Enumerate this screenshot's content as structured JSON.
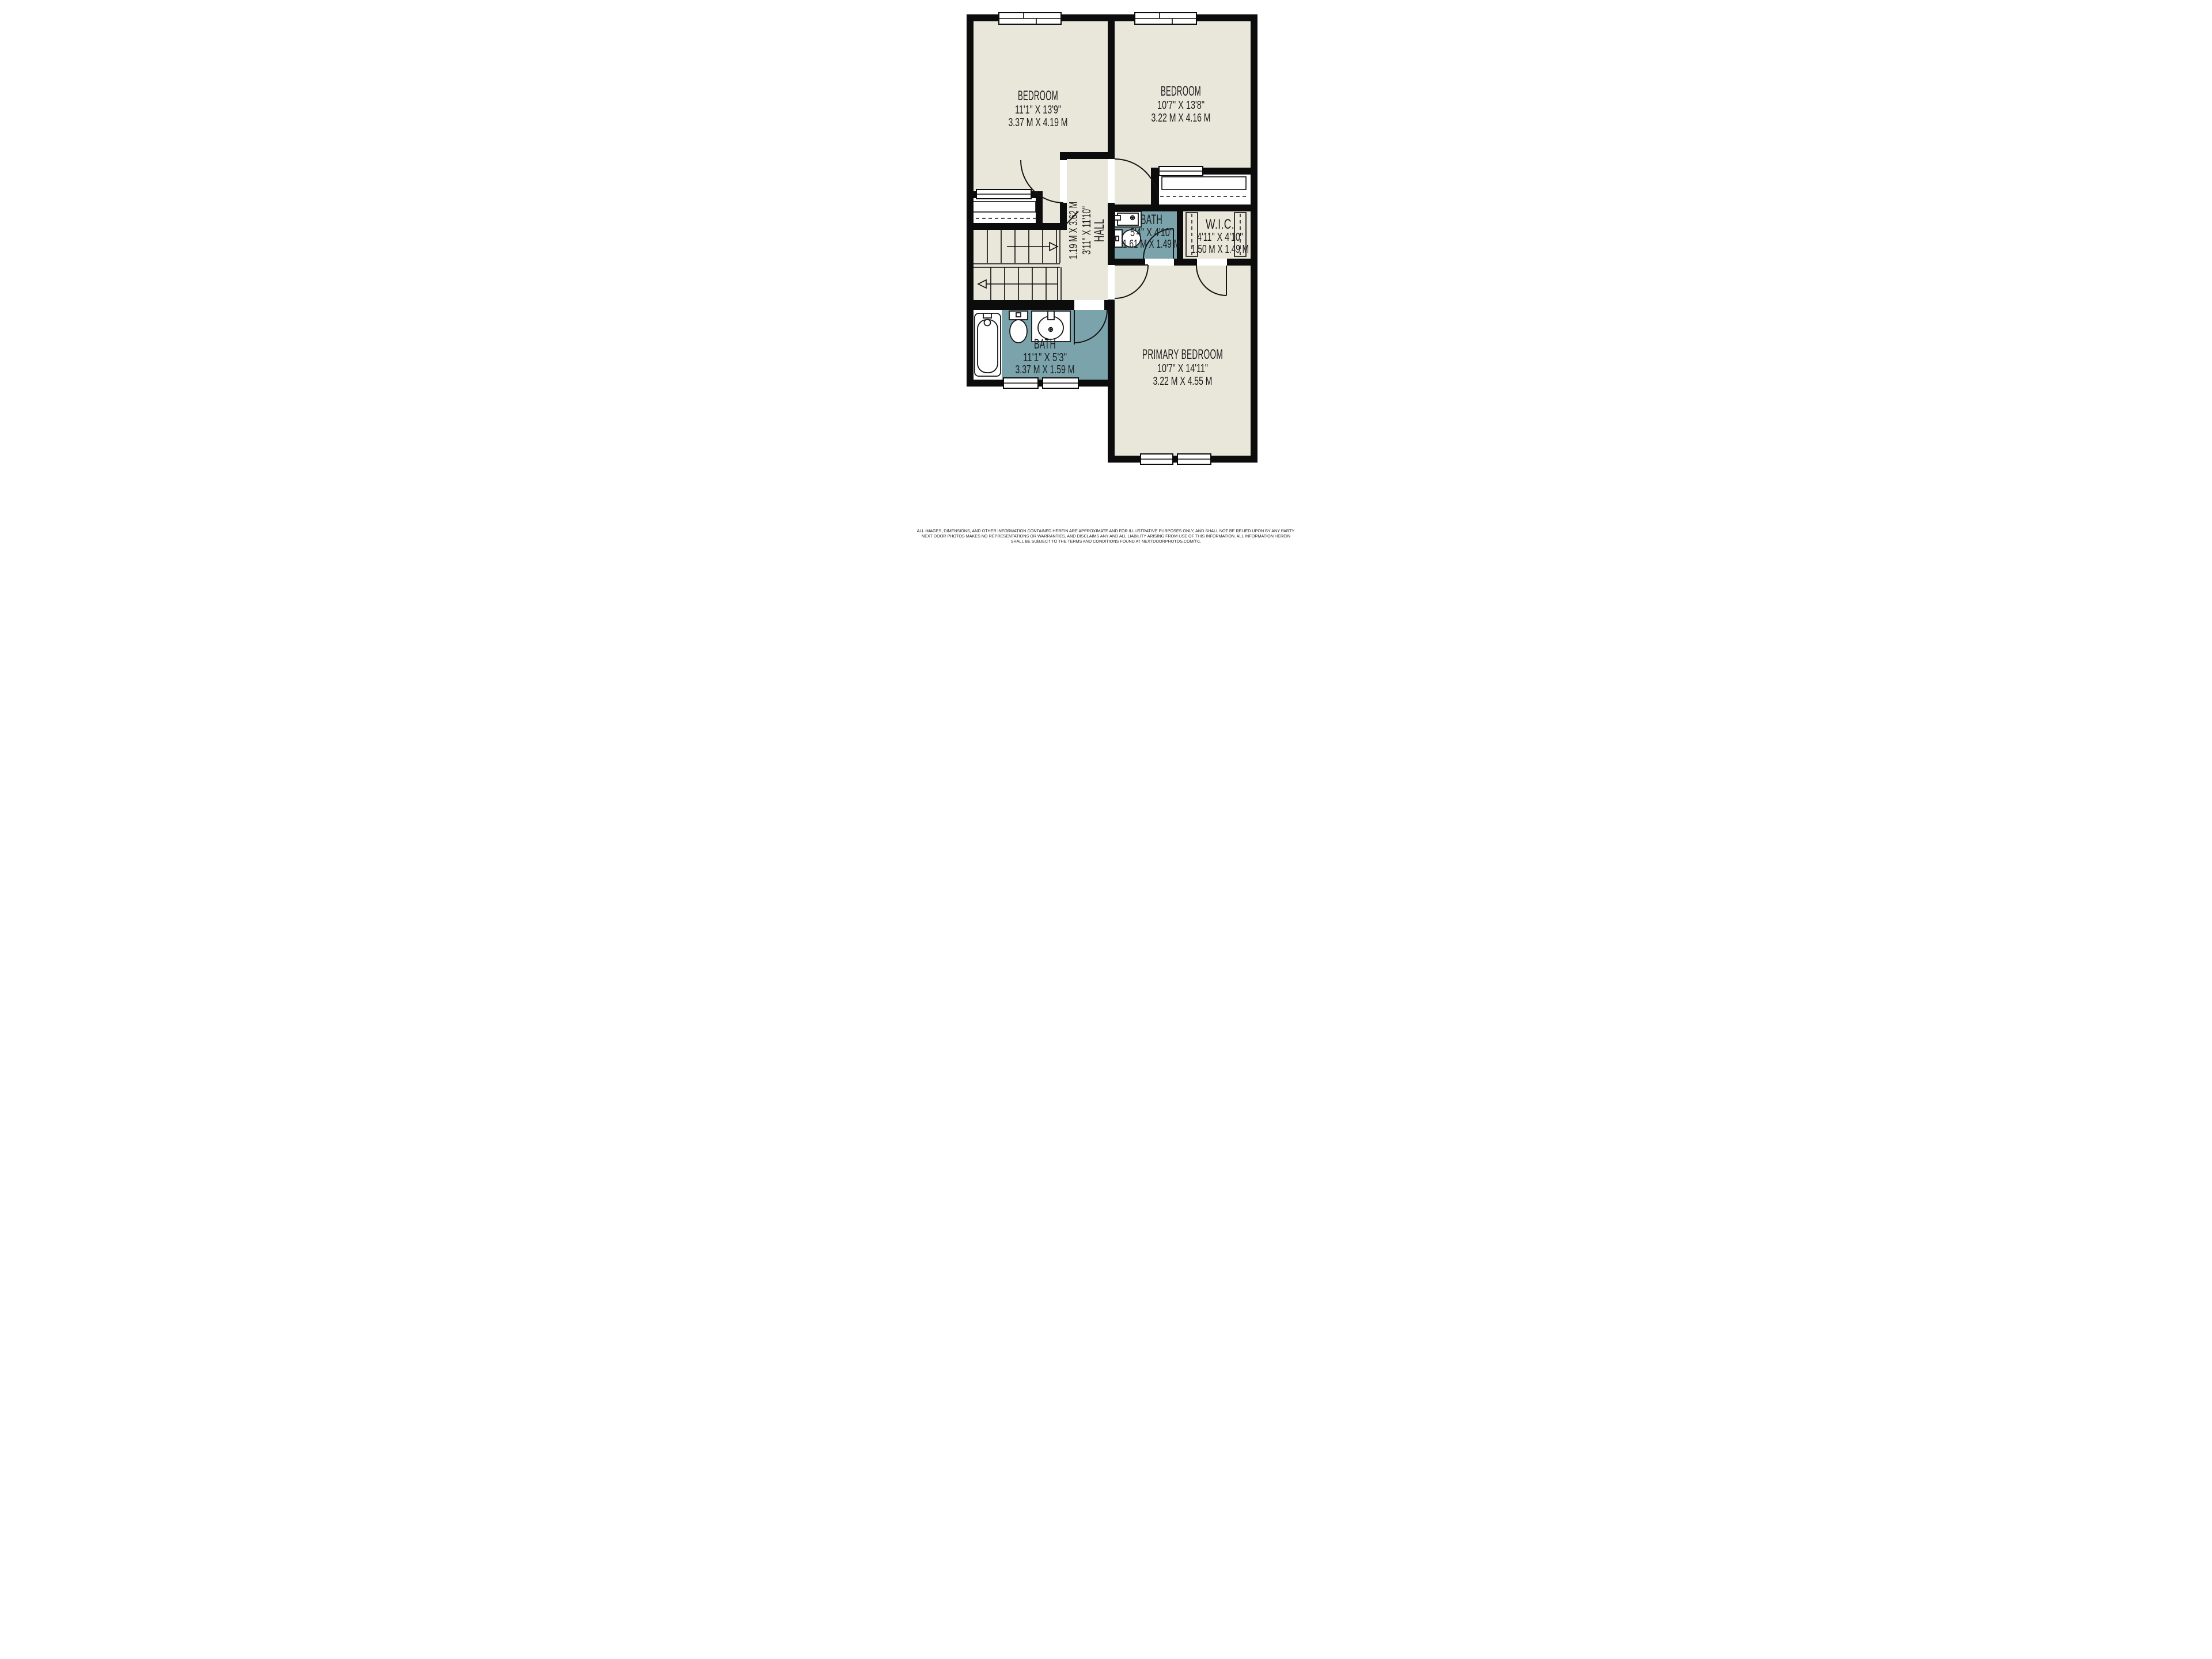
{
  "rooms": {
    "bedroom1": {
      "name": "BEDROOM",
      "imperial": "11'1\" X 13'9\"",
      "metric": "3.37 M X 4.19 M"
    },
    "bedroom2": {
      "name": "BEDROOM",
      "imperial": "10'7\" X 13'8\"",
      "metric": "3.22 M X 4.16 M"
    },
    "hall": {
      "name": "HALL",
      "imperial": "3'11\" X 11'10\"",
      "metric": "1.19 M X 3.62 M"
    },
    "bath_upper": {
      "name": "BATH",
      "imperial": "5'4\" X 4'10\"",
      "metric": "1.61 M X 1.49 M"
    },
    "wic": {
      "name": "W.I.C.",
      "imperial": "4'11\" X 4'10\"",
      "metric": "1.50 M X 1.49 M"
    },
    "bath_lower": {
      "name": "BATH",
      "imperial": "11'1\" X 5'3\"",
      "metric": "3.37 M X 1.59 M"
    },
    "primary": {
      "name": "PRIMARY BEDROOM",
      "imperial": "10'7\" X 14'11\"",
      "metric": "3.22 M X 4.55 M"
    }
  },
  "disclaimer": {
    "line1": "ALL IMAGES, DIMENSIONS, AND OTHER INFORMATION CONTAINED HEREIN ARE APPROXIMATE AND FOR ILLUSTRATIVE PURPOSES ONLY, AND SHALL NOT BE RELIED UPON BY ANY PARTY.",
    "line2": "NEXT DOOR PHOTOS MAKES NO REPRESENTATIONS OR WARRANTIES, AND DISCLAIMS ANY AND ALL LIABILITY ARISING FROM USE OF THIS INFORMATION. ALL INFORMATION HEREIN",
    "line3": "SHALL BE SUBJECT TO THE TERMS AND CONDITIONS FOUND AT NEXTDOORPHOTOS.COM/TC."
  },
  "colors": {
    "floor": "#e9e6da",
    "wet": "#7aa3ab",
    "wall": "#0c0c0c",
    "text": "#1d1d1d"
  }
}
